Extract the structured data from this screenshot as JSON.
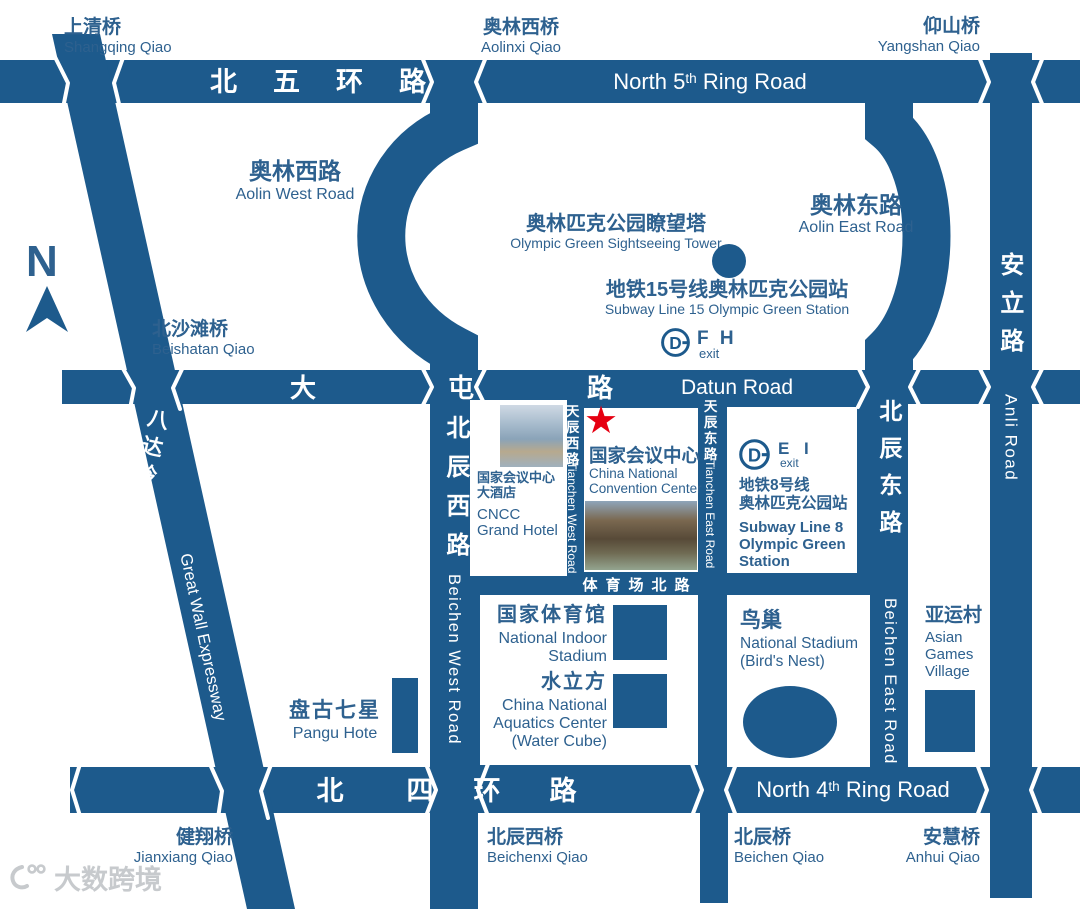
{
  "colors": {
    "road": "#1d5a8c",
    "ink": "#2e618f",
    "star_red": "#e60012",
    "white": "#ffffff"
  },
  "compass": {
    "letter": "N"
  },
  "watermark": {
    "text": "大数跨境"
  },
  "subway": {
    "logo_letter": "D"
  },
  "ring5": {
    "zh": "北五环路",
    "en_pre": "North 5",
    "en_sup": "th",
    "en_post": " Ring Road"
  },
  "ring4": {
    "zh_chars": [
      "北",
      "四",
      "环",
      "路"
    ],
    "en_pre": "North 4",
    "en_sup": "th",
    "en_post": " Ring Road"
  },
  "datun": {
    "zh_chars": [
      "大",
      "屯",
      "路"
    ],
    "en": "Datun Road"
  },
  "bridges": {
    "shangqing": {
      "zh": "上清桥",
      "en": "Shangqing Qiao"
    },
    "aolinxi": {
      "zh": "奥林西桥",
      "en": "Aolinxi Qiao"
    },
    "yangshan": {
      "zh": "仰山桥",
      "en": "Yangshan Qiao"
    },
    "beishatan": {
      "zh": "北沙滩桥",
      "en": "Beishatan Qiao"
    },
    "jianxiang": {
      "zh": "健翔桥",
      "en": "Jianxiang Qiao"
    },
    "beichenxi": {
      "zh": "北辰西桥",
      "en": "Beichenxi Qiao"
    },
    "beichenqiao": {
      "zh": "北辰桥",
      "en": "Beichen Qiao"
    },
    "anhui": {
      "zh": "安慧桥",
      "en": "Anhui Qiao"
    }
  },
  "roads": {
    "aolin_west": {
      "zh": "奥林西路",
      "en": "Aolin West Road"
    },
    "aolin_east": {
      "zh": "奥林东路",
      "en": "Aolin East Road"
    },
    "badaling": {
      "zh": "八达岭高速",
      "en": "Great Wall Expressway"
    },
    "beichen_west": {
      "zh": "北辰西路",
      "en": "Beichen West Road"
    },
    "beichen_east": {
      "zh": "北辰东路",
      "en": "Beichen East Road"
    },
    "anli": {
      "zh": "安立路",
      "en": "Anli Road"
    },
    "tianchen_west": {
      "zh": "天辰西路",
      "en": "Tianchen West Road"
    },
    "tianchen_east": {
      "zh": "天辰东路",
      "en": "Tianchen East Road"
    },
    "stadium_north": {
      "zh": "体育场北路"
    }
  },
  "pois": {
    "tower": {
      "zh": "奥林匹克公园瞭望塔",
      "en": "Olympic Green Sightseeing Tower"
    },
    "line15": {
      "zh": "地铁15号线奥林匹克公园站",
      "en": "Subway Line 15 Olympic Green Station",
      "exits": "F H",
      "exit_label": "exit"
    },
    "line8": {
      "zh1": "地铁8号线",
      "zh2": "奥林匹克公园站",
      "en1": "Subway Line 8",
      "en2": "Olympic Green",
      "en3": "Station",
      "exits": "E I",
      "exit_label": "exit"
    },
    "cncc": {
      "zh": "国家会议中心",
      "en1": "China National",
      "en2": "Convention Center"
    },
    "cncc_hotel": {
      "zh1": "国家会议中心",
      "zh2": "大酒店",
      "en1": "CNCC",
      "en2": "Grand Hotel"
    },
    "indoor_stadium": {
      "zh": "国家体育馆",
      "en1": "National Indoor",
      "en2": "Stadium"
    },
    "water_cube": {
      "zh": "水立方",
      "en1": "China National",
      "en2": "Aquatics Center",
      "en3": "(Water Cube)"
    },
    "birds_nest": {
      "zh": "鸟巢",
      "en1": "National Stadium",
      "en2": "(Bird's Nest)"
    },
    "asian_games": {
      "zh": "亚运村",
      "en1": "Asian",
      "en2": "Games",
      "en3": "Village"
    },
    "pangu": {
      "zh": "盘古七星",
      "en": "Pangu Hote"
    }
  }
}
